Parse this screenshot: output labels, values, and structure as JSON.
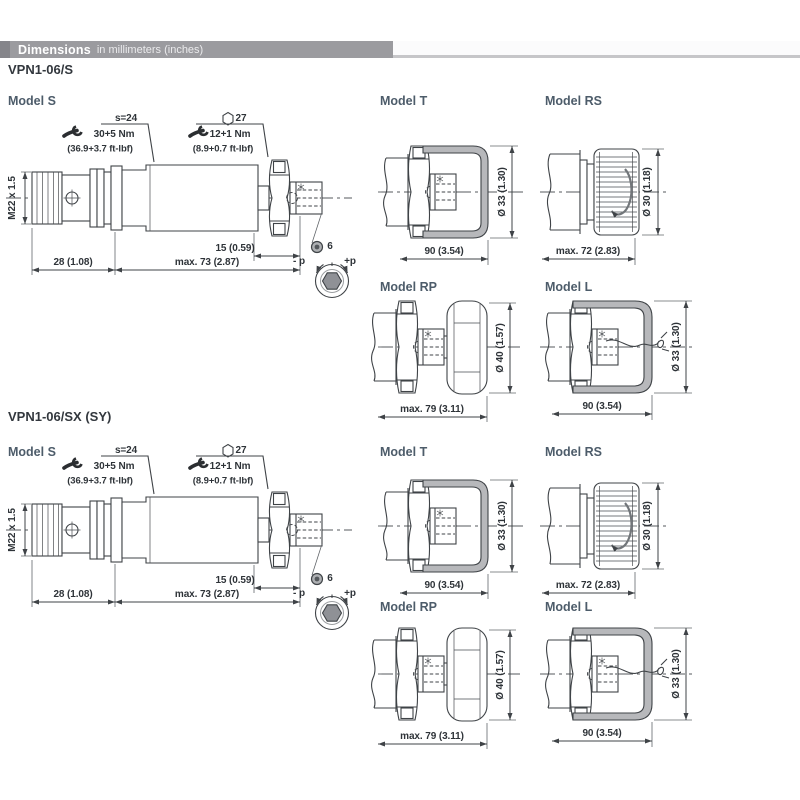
{
  "header": {
    "title": "Dimensions",
    "subtitle": "in millimeters (inches)"
  },
  "sections": [
    {
      "title": "VPN1-06/S"
    },
    {
      "title": "VPN1-06/SX (SY)"
    }
  ],
  "labels": {
    "model_s": "Model S",
    "model_t": "Model T",
    "model_rs": "Model RS",
    "model_rp": "Model RP",
    "model_l": "Model L"
  },
  "models": {
    "s": {
      "wrench_flats": "s=24",
      "hex": "27",
      "torque1": "30+5 Nm",
      "torque1_ft": "(36.9+3.7 ft-lbf)",
      "torque2": "12+1 Nm",
      "torque2_ft": "(8.9+0.7 ft-lbf)",
      "thread": "M22 x 1.5",
      "len_front": "28 (1.08)",
      "len_body": "max. 73 (2.87)",
      "len_adj": "15 (0.59)",
      "hex_socket": "6",
      "minus_p": "- p",
      "plus_p": "+p"
    },
    "t": {
      "dia": "Ø 33 (1.30)",
      "len": "90 (3.54)"
    },
    "rs": {
      "dia": "Ø 30 (1.18)",
      "len": "max. 72 (2.83)"
    },
    "rp": {
      "dia": "Ø 40 (1.57)",
      "len": "max. 79 (3.11)"
    },
    "l": {
      "dia": "Ø 33 (1.30)",
      "len": "90 (3.54)"
    }
  },
  "colors": {
    "header_bar": "#9b9b9f",
    "header_chip": "#85858a",
    "line": "#3f4347",
    "label": "#4d5c6a",
    "cap_fill": "#b7b8bb",
    "knob_hex_fill": "#8f9196"
  }
}
